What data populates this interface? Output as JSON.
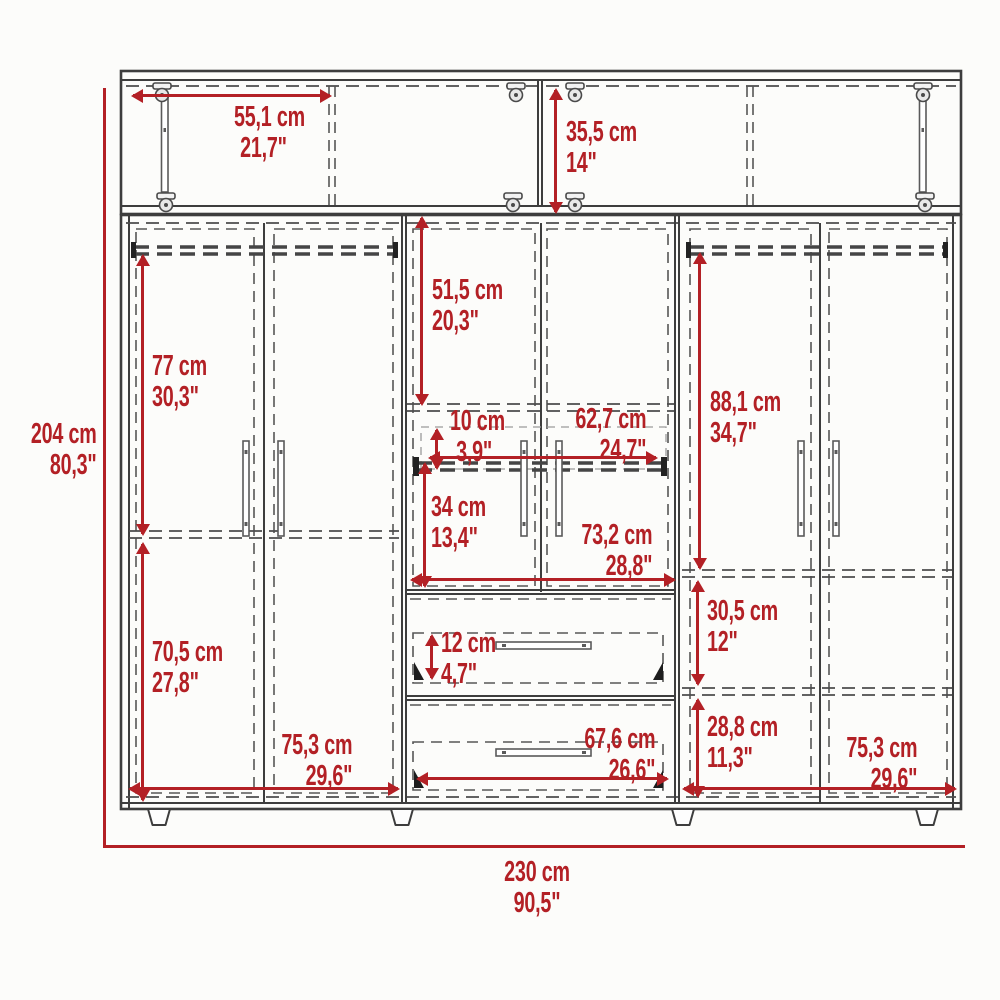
{
  "diagram": {
    "type": "furniture-dimension-drawing",
    "subject": "six-door wardrobe with top cabinet and two drawers",
    "accent_color": "#b32025",
    "line_color": "#3d3d3d",
    "units": [
      "cm",
      "inches"
    ]
  },
  "overall": {
    "height": {
      "cm": "204 cm",
      "in": "80,3\""
    },
    "width": {
      "cm": "230 cm",
      "in": "90,5\""
    }
  },
  "dims": {
    "top_door_width": {
      "cm": "55,1 cm",
      "in": "21,7\""
    },
    "top_height": {
      "cm": "35,5 cm",
      "in": "14\""
    },
    "mid_upper_height": {
      "cm": "51,5 cm",
      "in": "20,3\""
    },
    "left_upper_height": {
      "cm": "77 cm",
      "in": "30,3\""
    },
    "right_upper_height": {
      "cm": "88,1 cm",
      "in": "34,7\""
    },
    "rod_gap": {
      "cm": "10 cm",
      "in": "3,9\""
    },
    "rod_width": {
      "cm": "62,7 cm",
      "in": "24,7\""
    },
    "mid_lower_height": {
      "cm": "34 cm",
      "in": "13,4\""
    },
    "mid_width": {
      "cm": "73,2 cm",
      "in": "28,8\""
    },
    "right_shelf_height": {
      "cm": "30,5 cm",
      "in": "12\""
    },
    "drawer_height": {
      "cm": "12 cm",
      "in": "4,7\""
    },
    "right_lower_height": {
      "cm": "28,8 cm",
      "in": "11,3\""
    },
    "drawer_width": {
      "cm": "67,6 cm",
      "in": "26,6\""
    },
    "left_lower_height": {
      "cm": "70,5 cm",
      "in": "27,8\""
    },
    "left_width": {
      "cm": "75,3 cm",
      "in": "29,6\""
    },
    "right_width": {
      "cm": "75,3 cm",
      "in": "29,6\""
    }
  }
}
